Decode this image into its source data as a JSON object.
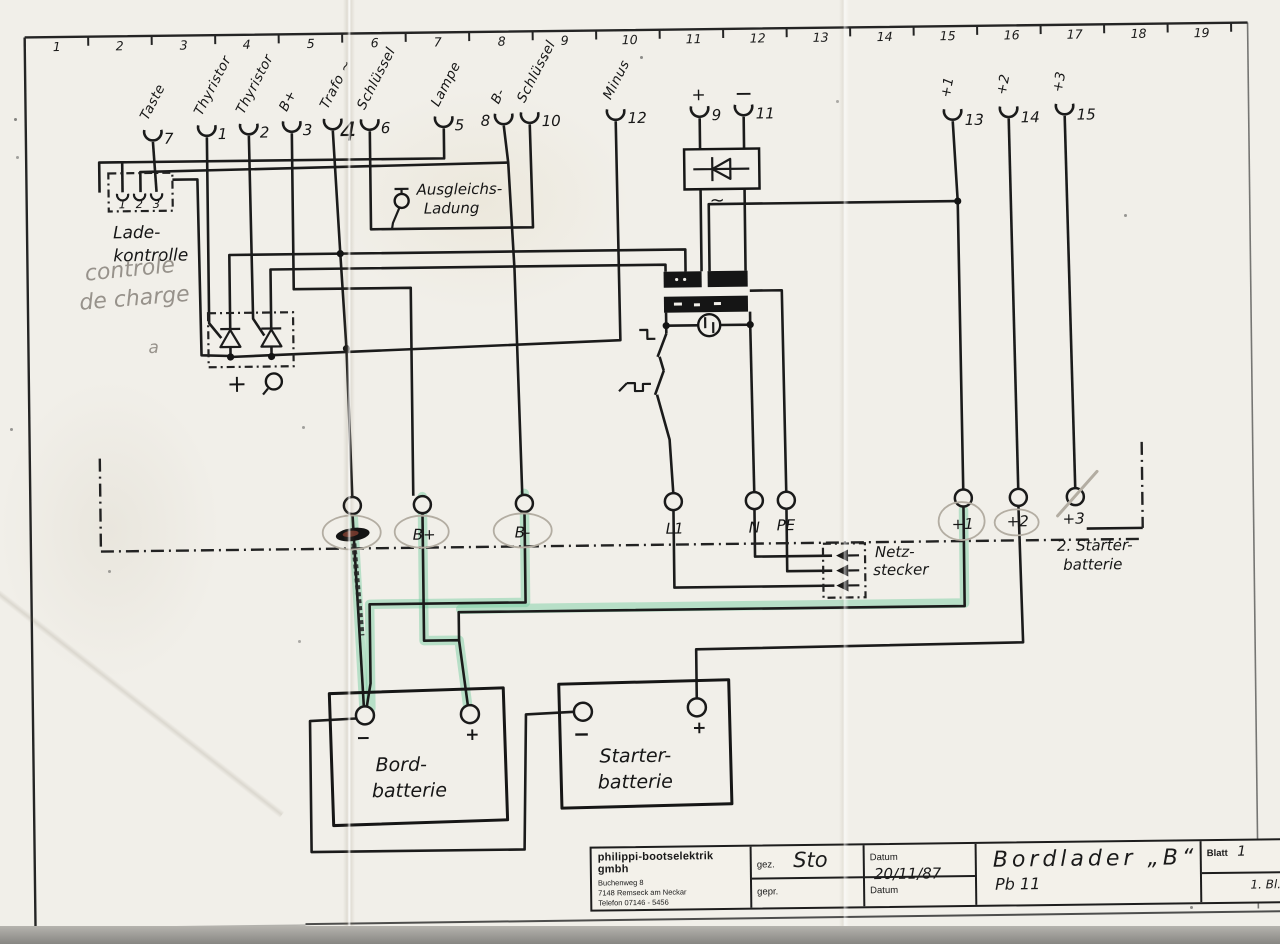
{
  "ruler": {
    "numbers": [
      "1",
      "2",
      "3",
      "4",
      "5",
      "6",
      "7",
      "8",
      "9",
      "10",
      "11",
      "12",
      "13",
      "14",
      "15",
      "16",
      "17",
      "18",
      "19"
    ]
  },
  "terminals": [
    {
      "label": "Taste",
      "num": "7"
    },
    {
      "label": "Thyristor",
      "num": "1"
    },
    {
      "label": "Thyristor",
      "num": "2"
    },
    {
      "label": "B+",
      "num": "3"
    },
    {
      "label": "Trafo ~",
      "num": "4"
    },
    {
      "label": "Schlüssel",
      "num": "6"
    },
    {
      "label": "Lampe",
      "num": "5"
    },
    {
      "label": "B-",
      "num": "8"
    },
    {
      "label": "Schlüssel",
      "num": "10"
    },
    {
      "label": "Minus",
      "num": "12"
    },
    {
      "label": "+",
      "num": "9"
    },
    {
      "label": "−",
      "num": "11"
    },
    {
      "label": "+1",
      "num": "13"
    },
    {
      "label": "+2",
      "num": "14"
    },
    {
      "label": "+3",
      "num": "15"
    }
  ],
  "ladekontrolle": {
    "line1": "Lade-",
    "line2": "kontrolle",
    "t1": "1",
    "t2": "2",
    "t3": "3",
    "pencil1": "controle",
    "pencil2": "de charge",
    "pencil3": "a"
  },
  "ausgleich": {
    "line1": "Ausgleichs-",
    "line2": "Ladung"
  },
  "thyristor_block": {
    "plus": "+"
  },
  "rectifier": {
    "ac": "~"
  },
  "bottom_terminals": {
    "bplus": "B+",
    "bminus": "B-",
    "l1": "L1",
    "n": "N",
    "pe": "PE",
    "p1": "+1",
    "p2": "+2",
    "p3": "+3"
  },
  "netzstecker": {
    "line1": "Netz-",
    "line2": "stecker"
  },
  "second_starter": {
    "line1": "2. Starter-",
    "line2": "batterie"
  },
  "bord_battery": {
    "line1": "Bord-",
    "line2": "batterie",
    "minus": "−",
    "plus": "+"
  },
  "starter_battery": {
    "line1": "Starter-",
    "line2": "batterie",
    "minus": "−",
    "plus": "+"
  },
  "title_block": {
    "company": "philippi-bootselektrik gmbh",
    "address1": "Buchenweg 8",
    "address2": "7148 Remseck am Neckar",
    "address3": "Telefon 07146 - 5456",
    "gez_label": "gez.",
    "gez_value": "Sto",
    "datum1_label": "Datum",
    "datum1_value": "20/11/87",
    "gepr_label": "gepr.",
    "datum2_label": "Datum",
    "title": "Bordlader „B“",
    "subtitle": "Pb 11",
    "blatt_label": "Blatt",
    "blatt_value": "1",
    "sheet": "1. Bl."
  }
}
